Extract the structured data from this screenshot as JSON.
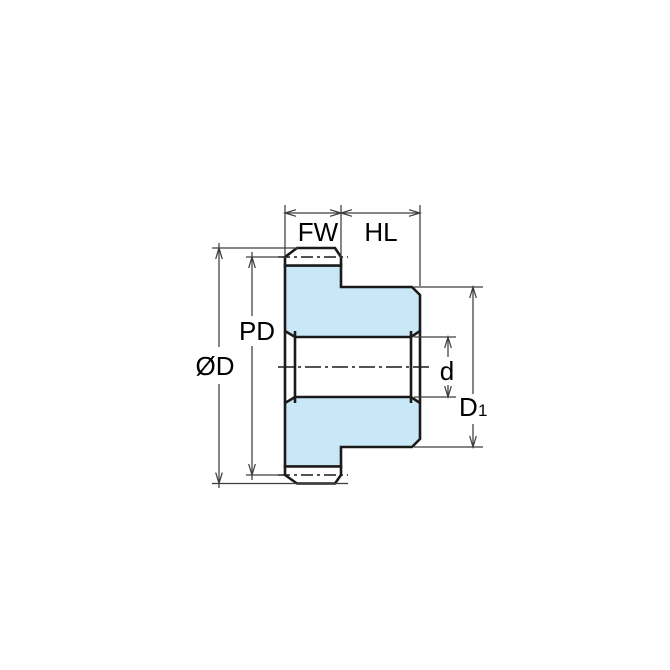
{
  "colors": {
    "part_fill": "#C8E8F8",
    "outline": "#1A1A1A",
    "dimension_lines": "#3D3D3D",
    "background": "#FFFFFF"
  },
  "dimensions": {
    "face_width": {
      "label": "FW"
    },
    "hub_length": {
      "label": "HL"
    },
    "pitch_diameter": {
      "label": "PD"
    },
    "outside_diameter": {
      "label": "ØD"
    },
    "bore_diameter": {
      "label": "d"
    },
    "hub_diameter": {
      "label": "D",
      "subscript": "1"
    }
  }
}
